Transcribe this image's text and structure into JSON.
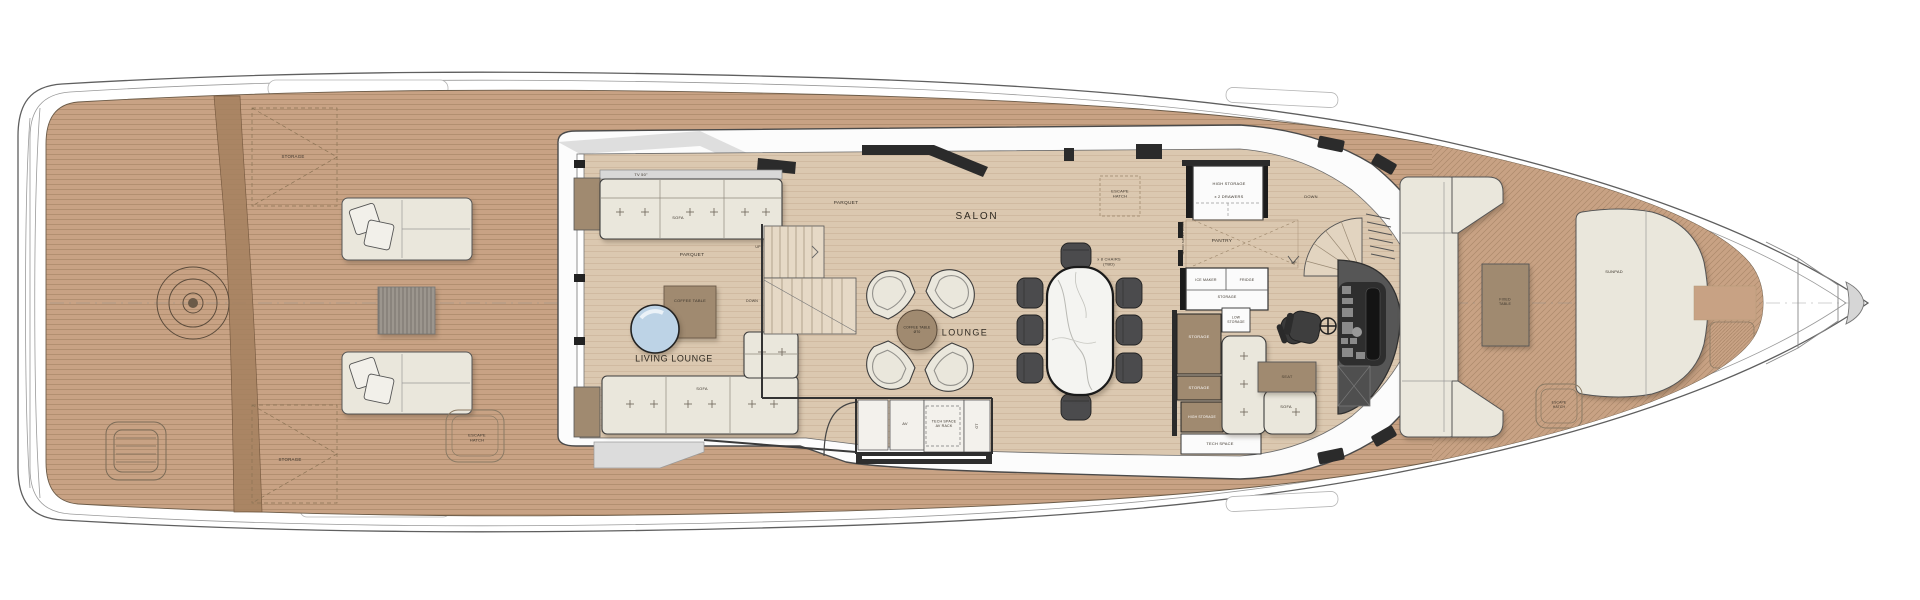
{
  "colors": {
    "teak": "#c8a284",
    "teakline": "#8a6a4c",
    "parquet": "#dbc8b0",
    "parquetline": "#b2937a",
    "hull": "#ffffff",
    "outline": "#5f5f5f",
    "walldark": "#2b2b2b",
    "fabric": "#eae7dc",
    "wood": "#a08a70",
    "marble": "#f4f4f1",
    "glass": "#bdd3e6",
    "seatdark": "#4b4b4d",
    "label": "#3a332a"
  },
  "aft": {
    "storage_top": "STORAGE",
    "storage_bottom": "STORAGE",
    "escape_hatch": "ESCAPE\nHATCH"
  },
  "lounge": {
    "name": "LIVING LOUNGE",
    "tv": "TV 50\"",
    "sofa_top": "SOFA",
    "sofa_bottom": "SOFA",
    "parquet_a": "PARQUET",
    "parquet_b": "PARQUET",
    "coffee_table": "COFFEE TABLE",
    "up": "UP",
    "down": "DOWN"
  },
  "salon": {
    "name": "SALON",
    "lounge": "LOUNGE",
    "coffee_table": "COFFEE TABLE\nØ70",
    "chairs": "x 8 CHAIRS\n(TBD)",
    "escape_hatch": "ESCAPE\nHATCH",
    "av": "AV",
    "tech_space": "TECH SPACE\nAV RACK",
    "gt": "GT"
  },
  "galley": {
    "high_storage": "HIGH STORAGE",
    "drawers": "x 2 DRAWERS",
    "pantry": "PANTRY",
    "door": "WOOD SWING DOOR",
    "ice_maker": "ICE MAKER",
    "fridge": "FRIDGE",
    "storage": "STORAGE",
    "down": "DOWN",
    "up": "UP"
  },
  "stb": {
    "low_storage": "LOW\nSTORAGE",
    "storage_fwd": "STORAGE",
    "storage_mid": "STORAGE",
    "high_storage": "HIGH STORAGE",
    "tech_space": "TECH SPACE",
    "seat": "SEAT",
    "sofa": "SOFA"
  },
  "bow": {
    "table": "FIXED\nTABLE",
    "sunpad": "SUNPAD",
    "escape_hatch": "ESCAPE\nHATCH"
  }
}
